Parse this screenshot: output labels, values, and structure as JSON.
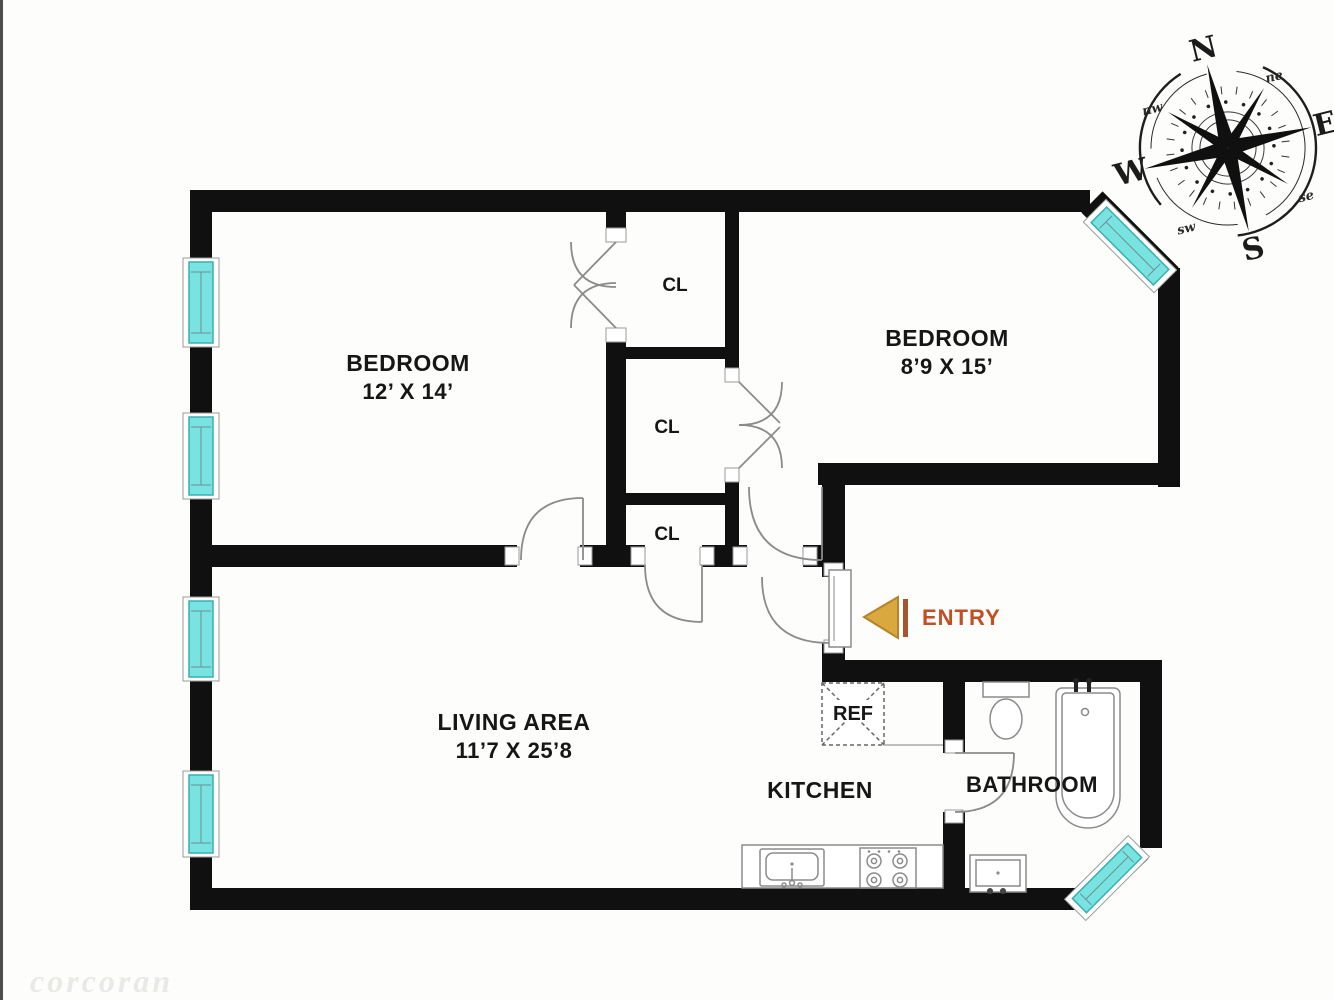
{
  "meta": {
    "background": "#fdfdfc",
    "wall_color": "#101010",
    "window_color": "#79e3e2",
    "window_border": "#39afb0",
    "door_stroke": "#8b8b8b",
    "entry_text_color": "#c24e24",
    "entry_arrow_fill": "#d9a83e",
    "entry_arrow_outline": "#b5832b",
    "entry_bar_color": "#a8542c"
  },
  "rooms": [
    {
      "id": "bedroom-1",
      "name": "BEDROOM",
      "dimensions": "12’ X 14’"
    },
    {
      "id": "bedroom-2",
      "name": "BEDROOM",
      "dimensions": "8’9 X 15’"
    },
    {
      "id": "living-area",
      "name": "LIVING AREA",
      "dimensions": "11’7 X 25’8"
    },
    {
      "id": "kitchen",
      "name": "KITCHEN"
    },
    {
      "id": "bathroom",
      "name": "BATHROOM"
    }
  ],
  "closets": [
    {
      "label": "CL"
    },
    {
      "label": "CL"
    },
    {
      "label": "CL"
    }
  ],
  "appliances": {
    "refrigerator": "REF"
  },
  "entry": {
    "label": "ENTRY"
  },
  "compass": {
    "cardinal": {
      "n": "N",
      "e": "E",
      "s": "S",
      "w": "W"
    },
    "intercardinal": {
      "ne": "ne",
      "se": "se",
      "sw": "sw",
      "nw": "nw"
    }
  },
  "watermark": "corcoran"
}
